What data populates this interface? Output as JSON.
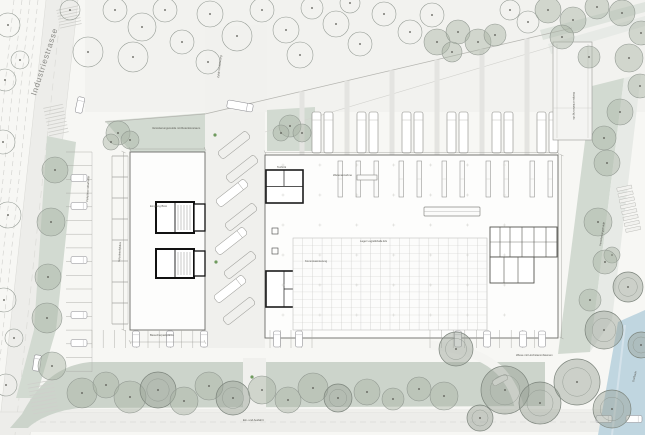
{
  "title": "Situationsplan Gewerbe- und Logistikareal",
  "street": {
    "label": "Industriestrasse"
  },
  "colors": {
    "paper": "#f7f7f4",
    "top_ground": "#f2f2ef",
    "road": "#ededea",
    "green": "#d2dad1",
    "green_band": "#ccd4cb",
    "green_light": "#dfe4de",
    "water": "#c0d6e0",
    "building": "#fdfdfc",
    "yard": "#f0f0ed",
    "wall": "#1a1a1a",
    "outline": "#6b6b68",
    "tree_line": "#8f968f",
    "annotation": "#55554f"
  },
  "annotations": [
    {
      "text": "Versickerungsmulde mit Retentionsraum",
      "x": 152,
      "y": 129,
      "rot": 0,
      "size": 2.7
    },
    {
      "text": "Zufahrt Anlieferung",
      "x": 219,
      "y": 78,
      "rot": -83,
      "size": 2.7
    },
    {
      "text": "Warenannahme",
      "x": 333,
      "y": 176,
      "rot": 0,
      "size": 2.7
    },
    {
      "text": "Lager Logistikhalle EG",
      "x": 360,
      "y": 242,
      "rot": 0,
      "size": 2.7
    },
    {
      "text": "Kommissionierung",
      "x": 305,
      "y": 262,
      "rot": 0,
      "size": 2.4
    },
    {
      "text": "Technik",
      "x": 277,
      "y": 168,
      "rot": 0,
      "size": 2.4
    },
    {
      "text": "Empfang Büro",
      "x": 150,
      "y": 207,
      "rot": 0,
      "size": 2.7
    },
    {
      "text": "Rampe Anlieferung UG",
      "x": 573,
      "y": 92,
      "rot": 90,
      "size": 2.7
    },
    {
      "text": "Versickerungsmulde",
      "x": 601,
      "y": 246,
      "rot": -81,
      "size": 2.7
    },
    {
      "text": "Besucherparkplätze",
      "x": 150,
      "y": 336,
      "rot": 0,
      "size": 2.7
    },
    {
      "text": "Ein- und Ausfahrt",
      "x": 243,
      "y": 421,
      "rot": 0,
      "size": 2.7
    },
    {
      "text": "Parkplätze Mitarbeiter",
      "x": 88,
      "y": 202,
      "rot": -87,
      "size": 2.7
    },
    {
      "text": "Wiese mit Hochstammbäumen",
      "x": 516,
      "y": 356,
      "rot": 0,
      "size": 2.7
    },
    {
      "text": "Dorfbach",
      "x": 634,
      "y": 382,
      "rot": -76,
      "size": 2.7
    },
    {
      "text": "Veloabstellplätze",
      "x": 120,
      "y": 262,
      "rot": -87,
      "size": 2.4
    }
  ],
  "trees": [
    [
      8,
      25,
      12,
      0
    ],
    [
      20,
      60,
      9,
      0
    ],
    [
      5,
      80,
      11,
      0
    ],
    [
      3,
      142,
      12,
      0
    ],
    [
      8,
      215,
      13,
      0
    ],
    [
      4,
      300,
      12,
      0
    ],
    [
      6,
      385,
      11,
      0
    ],
    [
      14,
      338,
      9,
      0
    ],
    [
      88,
      52,
      15,
      0
    ],
    [
      70,
      10,
      10,
      0
    ],
    [
      115,
      10,
      12,
      0
    ],
    [
      142,
      27,
      14,
      0
    ],
    [
      165,
      10,
      12,
      0
    ],
    [
      133,
      57,
      15,
      0
    ],
    [
      182,
      42,
      12,
      0
    ],
    [
      210,
      14,
      13,
      0
    ],
    [
      237,
      36,
      15,
      0
    ],
    [
      208,
      62,
      12,
      0
    ],
    [
      262,
      10,
      12,
      0
    ],
    [
      286,
      30,
      13,
      0
    ],
    [
      312,
      8,
      11,
      0
    ],
    [
      300,
      55,
      13,
      0
    ],
    [
      336,
      24,
      13,
      0
    ],
    [
      360,
      44,
      12,
      0
    ],
    [
      384,
      14,
      12,
      0
    ],
    [
      350,
      3,
      10,
      0
    ],
    [
      410,
      32,
      12,
      0
    ],
    [
      432,
      15,
      12,
      0
    ],
    [
      528,
      22,
      11,
      0
    ],
    [
      510,
      10,
      10,
      0
    ],
    [
      437,
      42,
      13,
      1
    ],
    [
      458,
      32,
      12,
      1
    ],
    [
      478,
      42,
      13,
      1
    ],
    [
      452,
      52,
      10,
      1
    ],
    [
      495,
      35,
      11,
      1
    ],
    [
      548,
      10,
      13,
      1
    ],
    [
      573,
      20,
      13,
      1
    ],
    [
      597,
      7,
      12,
      1
    ],
    [
      622,
      13,
      13,
      1
    ],
    [
      641,
      33,
      12,
      1
    ],
    [
      629,
      58,
      14,
      1
    ],
    [
      640,
      86,
      12,
      1
    ],
    [
      620,
      112,
      13,
      1
    ],
    [
      604,
      138,
      12,
      1
    ],
    [
      589,
      57,
      11,
      1
    ],
    [
      562,
      37,
      12,
      1
    ],
    [
      607,
      163,
      13,
      1
    ],
    [
      598,
      222,
      14,
      1
    ],
    [
      612,
      255,
      8,
      1
    ],
    [
      605,
      262,
      12,
      1
    ],
    [
      590,
      300,
      11,
      1
    ],
    [
      456,
      349,
      17,
      2
    ],
    [
      505,
      390,
      24,
      2
    ],
    [
      540,
      403,
      21,
      2
    ],
    [
      577,
      382,
      23,
      2
    ],
    [
      612,
      409,
      19,
      2
    ],
    [
      604,
      330,
      19,
      2
    ],
    [
      628,
      287,
      15,
      2
    ],
    [
      641,
      345,
      13,
      2
    ],
    [
      480,
      418,
      13,
      2
    ],
    [
      82,
      393,
      15,
      1
    ],
    [
      106,
      385,
      13,
      1
    ],
    [
      130,
      397,
      16,
      1
    ],
    [
      158,
      390,
      18,
      2
    ],
    [
      184,
      401,
      14,
      1
    ],
    [
      209,
      386,
      14,
      1
    ],
    [
      233,
      398,
      17,
      2
    ],
    [
      262,
      390,
      14,
      1
    ],
    [
      288,
      400,
      13,
      1
    ],
    [
      313,
      388,
      15,
      1
    ],
    [
      338,
      398,
      14,
      2
    ],
    [
      367,
      392,
      13,
      1
    ],
    [
      393,
      399,
      11,
      1
    ],
    [
      419,
      389,
      12,
      1
    ],
    [
      444,
      396,
      14,
      1
    ],
    [
      55,
      170,
      13,
      1
    ],
    [
      51,
      222,
      14,
      1
    ],
    [
      48,
      277,
      13,
      1
    ],
    [
      47,
      318,
      15,
      1
    ],
    [
      52,
      366,
      14,
      1
    ],
    [
      118,
      133,
      12,
      1
    ],
    [
      130,
      140,
      9,
      1
    ],
    [
      111,
      142,
      8,
      1
    ],
    [
      290,
      126,
      11,
      1
    ],
    [
      302,
      133,
      9,
      1
    ],
    [
      281,
      133,
      8,
      1
    ]
  ],
  "green_dots": [
    [
      215,
      135
    ],
    [
      216,
      262
    ],
    [
      252,
      377
    ]
  ],
  "vehicles": {
    "cars": [
      {
        "x": 80,
        "y": 105,
        "rot": 12
      },
      {
        "x": 37,
        "y": 363,
        "rot": 8
      },
      {
        "x": 604,
        "y": 419,
        "rot": 90
      },
      {
        "x": 634,
        "y": 419,
        "rot": 90
      },
      {
        "x": 79,
        "y": 178,
        "rot": 90
      },
      {
        "x": 79,
        "y": 206,
        "rot": 90
      },
      {
        "x": 79,
        "y": 260,
        "rot": 90
      },
      {
        "x": 79,
        "y": 315,
        "rot": 90
      },
      {
        "x": 79,
        "y": 343,
        "rot": 90
      },
      {
        "x": 136,
        "y": 339,
        "rot": 0
      },
      {
        "x": 170,
        "y": 339,
        "rot": 0
      },
      {
        "x": 204,
        "y": 339,
        "rot": 0
      },
      {
        "x": 277,
        "y": 339,
        "rot": 0
      },
      {
        "x": 299,
        "y": 339,
        "rot": 0
      },
      {
        "x": 458,
        "y": 339,
        "rot": 0
      },
      {
        "x": 487,
        "y": 339,
        "rot": 0
      },
      {
        "x": 523,
        "y": 339,
        "rot": 0
      },
      {
        "x": 542,
        "y": 339,
        "rot": 0
      }
    ],
    "road_trucks": [
      {
        "x": 240,
        "y": 106,
        "rot": -80,
        "len": 26
      }
    ]
  },
  "yard_bays": {
    "angle": -38,
    "w": 36,
    "h": 9,
    "slots": [
      {
        "cx": 234,
        "cy": 145,
        "truck": false
      },
      {
        "cx": 242,
        "cy": 169,
        "truck": false
      },
      {
        "cx": 232,
        "cy": 193,
        "truck": true
      },
      {
        "cx": 241,
        "cy": 217,
        "truck": false
      },
      {
        "cx": 231,
        "cy": 241,
        "truck": true
      },
      {
        "cx": 240,
        "cy": 265,
        "truck": false
      },
      {
        "cx": 230,
        "cy": 289,
        "truck": true
      },
      {
        "cx": 239,
        "cy": 311,
        "truck": false
      }
    ]
  },
  "dock_trucks": {
    "pair_xs": [
      312,
      357,
      402,
      447,
      492,
      537
    ],
    "gap": 12,
    "y": 112,
    "w": 9,
    "h": 41
  },
  "mullions": {
    "xs": [
      302,
      347,
      392,
      437,
      482,
      527
    ],
    "w": 5,
    "bottom": 155
  },
  "racks": {
    "upper_xs": [
      338,
      356,
      374,
      399,
      417,
      442,
      460,
      486,
      504,
      530,
      548
    ],
    "y": 161,
    "w": 4.5,
    "h": 36
  },
  "grid_zone": {
    "x": 293,
    "y": 238,
    "w": 194,
    "h": 92,
    "col_step": 9.7,
    "row_step": 7.7
  },
  "parking_rows": [
    {
      "type": "h",
      "x1": 66,
      "x2": 92,
      "from": 152,
      "to": 372,
      "step": 13.7
    },
    {
      "type": "h",
      "x1": 112,
      "x2": 128,
      "from": 156,
      "to": 324,
      "step": 21
    },
    {
      "type": "v",
      "y1": 330,
      "y2": 348,
      "from": 92,
      "to": 215,
      "step": 11.2
    },
    {
      "type": "v",
      "y1": 330,
      "y2": 348,
      "from": 270,
      "to": 312,
      "step": 10.5
    },
    {
      "type": "v",
      "y1": 330,
      "y2": 348,
      "from": 430,
      "to": 546,
      "step": 11.6
    }
  ],
  "hatches": [
    {
      "x": 58,
      "y": 8,
      "w": 22,
      "h": 18,
      "rot": -12,
      "lines": 6
    },
    {
      "x": 46,
      "y": 106,
      "w": 20,
      "h": 28,
      "rot": -12,
      "lines": 8
    },
    {
      "x": 30,
      "y": 382,
      "w": 26,
      "h": 30,
      "rot": -10,
      "lines": 8
    }
  ],
  "steps": {
    "cx": 629,
    "cy": 210,
    "count": 8,
    "w": 15,
    "h": 3.4,
    "gap": 6,
    "rot": -12
  }
}
